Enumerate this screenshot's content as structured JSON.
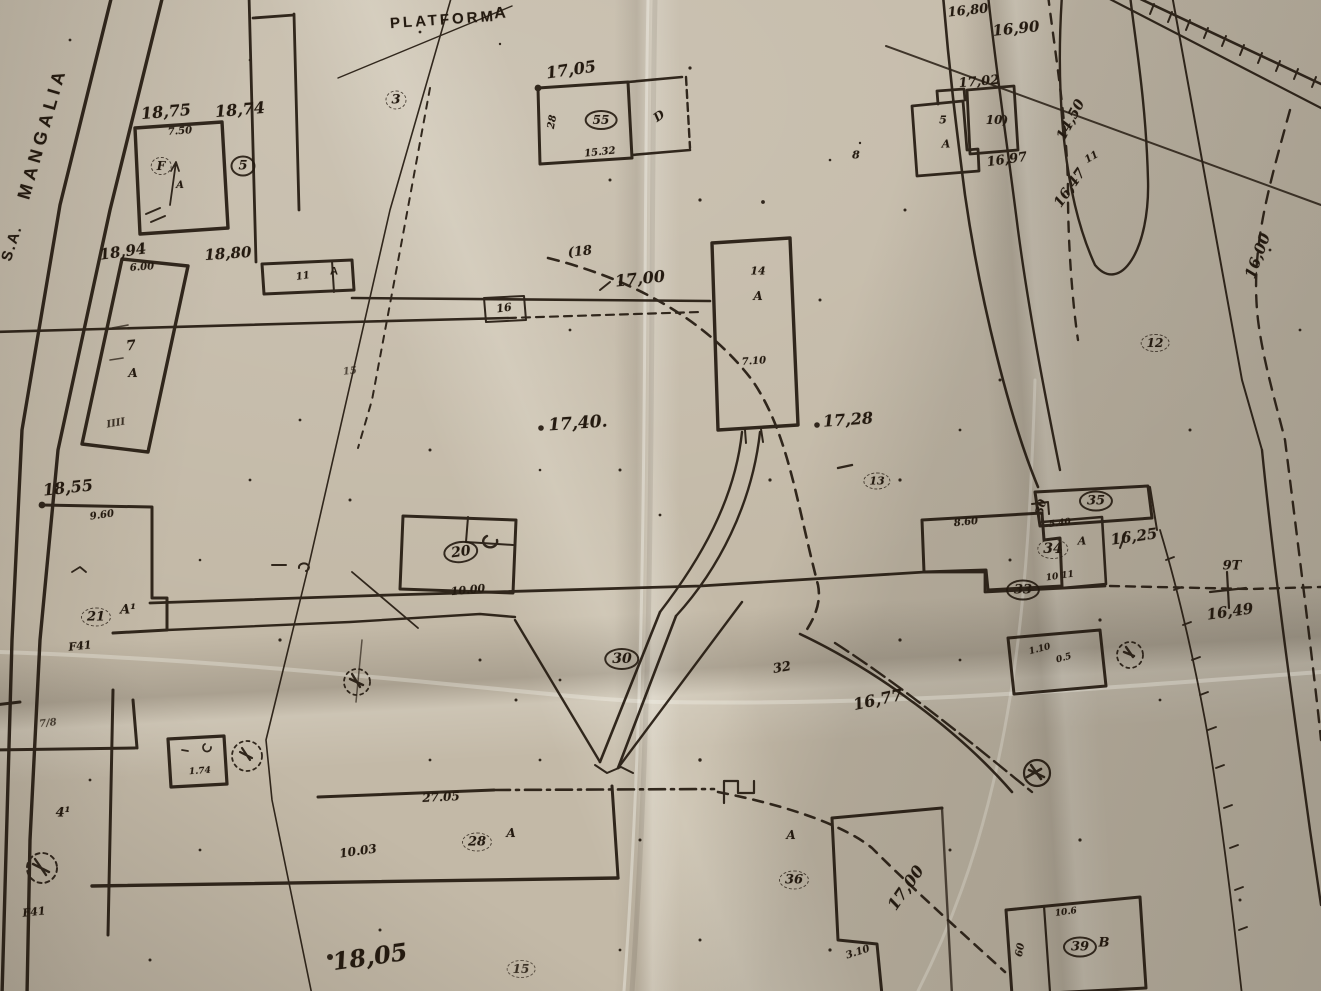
{
  "document": {
    "kind": "hand-drawn cadastral site plan on creased paper",
    "street_name": "MANGALIA",
    "street_prefix": "S.A.",
    "area_title": "PLATFORMA"
  },
  "colors": {
    "paper": "#c3b9a7",
    "paper_light": "#d6cdbc",
    "paper_shadow": "#968e80",
    "ink": "#241a10"
  },
  "labels": [
    {
      "id": "street-prefix",
      "t": "S.A.",
      "x": 12,
      "y": 243,
      "r": -72,
      "s": 15,
      "st": 1,
      "ls": 2
    },
    {
      "id": "street-mangalia",
      "t": "MANGALIA",
      "x": 42,
      "y": 133,
      "r": -74,
      "s": 18,
      "st": 1,
      "ls": 5
    },
    {
      "id": "platforma",
      "t": "PLATFORM",
      "x": 443,
      "y": 20,
      "r": -4,
      "s": 15,
      "st": 1,
      "ls": 3
    },
    {
      "id": "platforma-a",
      "t": "A",
      "x": 500,
      "y": 14,
      "r": -4,
      "s": 16,
      "st": 1
    },
    {
      "id": "pt-3",
      "t": "3",
      "x": 396,
      "y": 100,
      "r": 0,
      "s": 13,
      "c": "d"
    },
    {
      "id": "elev-1875",
      "t": "18,75",
      "x": 166,
      "y": 112,
      "r": -5,
      "s": 16
    },
    {
      "id": "dim-750",
      "t": "7.50",
      "x": 180,
      "y": 132,
      "r": -4,
      "s": 10
    },
    {
      "id": "bldg-F",
      "t": "F",
      "x": 161,
      "y": 166,
      "r": 0,
      "s": 12,
      "c": "d"
    },
    {
      "id": "bldg-F-a",
      "t": "A",
      "x": 180,
      "y": 186,
      "r": 0,
      "s": 10
    },
    {
      "id": "elev-1874",
      "t": "18,74",
      "x": 240,
      "y": 110,
      "r": -5,
      "s": 16
    },
    {
      "id": "pt-5",
      "t": "5",
      "x": 243,
      "y": 166,
      "r": 0,
      "s": 13,
      "c": "s"
    },
    {
      "id": "elev-1894",
      "t": "18,94",
      "x": 123,
      "y": 252,
      "r": -8,
      "s": 15
    },
    {
      "id": "elev-1880",
      "t": "18,80",
      "x": 228,
      "y": 254,
      "r": -4,
      "s": 15
    },
    {
      "id": "dim-600",
      "t": "6.00",
      "x": 142,
      "y": 268,
      "r": -4,
      "s": 10
    },
    {
      "id": "bldg-7",
      "t": "7",
      "x": 131,
      "y": 346,
      "r": -6,
      "s": 14
    },
    {
      "id": "bldg-7-a",
      "t": "A",
      "x": 133,
      "y": 373,
      "r": 0,
      "s": 12
    },
    {
      "id": "hatch-iiii",
      "t": "IIII",
      "x": 116,
      "y": 424,
      "r": -10,
      "s": 10,
      "o": 0.85
    },
    {
      "id": "box-11",
      "t": "11",
      "x": 303,
      "y": 277,
      "r": -8,
      "s": 10
    },
    {
      "id": "box-11-a",
      "t": "A",
      "x": 334,
      "y": 272,
      "r": 0,
      "s": 11,
      "st": 1
    },
    {
      "id": "road-16",
      "t": "16",
      "x": 504,
      "y": 308,
      "r": -8,
      "s": 11
    },
    {
      "id": "elev-1700",
      "t": "17,00",
      "x": 640,
      "y": 279,
      "r": -6,
      "s": 16
    },
    {
      "id": "ctr-18",
      "t": "(18",
      "x": 580,
      "y": 252,
      "r": -6,
      "s": 13
    },
    {
      "id": "pt-15a",
      "t": "15",
      "x": 350,
      "y": 372,
      "r": -6,
      "s": 10,
      "o": 0.7
    },
    {
      "id": "bldg-14",
      "t": "14",
      "x": 758,
      "y": 271,
      "r": 0,
      "s": 11
    },
    {
      "id": "bldg-14-a",
      "t": "A",
      "x": 758,
      "y": 296,
      "r": 0,
      "s": 12
    },
    {
      "id": "dim-710",
      "t": "7.10",
      "x": 754,
      "y": 362,
      "r": -4,
      "s": 10
    },
    {
      "id": "elev-1740",
      "t": "17,40.",
      "x": 578,
      "y": 424,
      "r": -4,
      "s": 17
    },
    {
      "id": "elev-1728",
      "t": "17,28",
      "x": 848,
      "y": 420,
      "r": -4,
      "s": 16
    },
    {
      "id": "ctr-13",
      "t": "13",
      "x": 877,
      "y": 481,
      "r": 0,
      "s": 11,
      "c": "d"
    },
    {
      "id": "pt-8",
      "t": "8",
      "x": 856,
      "y": 155,
      "r": 0,
      "s": 11
    },
    {
      "id": "elev-1680",
      "t": "16,80",
      "x": 968,
      "y": 11,
      "r": -6,
      "s": 13
    },
    {
      "id": "elev-1690",
      "t": "16,90",
      "x": 1016,
      "y": 29,
      "r": -6,
      "s": 15
    },
    {
      "id": "elev-1702",
      "t": "17,02",
      "x": 979,
      "y": 82,
      "r": -5,
      "s": 13
    },
    {
      "id": "bldg-5",
      "t": "5",
      "x": 943,
      "y": 120,
      "r": 0,
      "s": 11
    },
    {
      "id": "bldg-5-a",
      "t": "A",
      "x": 946,
      "y": 144,
      "r": 0,
      "s": 11
    },
    {
      "id": "bldg-10",
      "t": "10)",
      "x": 997,
      "y": 120,
      "r": 0,
      "s": 12
    },
    {
      "id": "elev-1697",
      "t": "16,97",
      "x": 1007,
      "y": 160,
      "r": -8,
      "s": 13
    },
    {
      "id": "elev-1450",
      "t": "14,50",
      "x": 1071,
      "y": 120,
      "r": -62,
      "s": 14
    },
    {
      "id": "elev-1647",
      "t": "16,47",
      "x": 1070,
      "y": 188,
      "r": -55,
      "s": 14
    },
    {
      "id": "marks-11",
      "t": "11",
      "x": 1092,
      "y": 158,
      "r": -30,
      "s": 10
    },
    {
      "id": "ctr-1600",
      "t": "16,00",
      "x": 1258,
      "y": 256,
      "r": -70,
      "s": 15
    },
    {
      "id": "pt-12",
      "t": "12",
      "x": 1155,
      "y": 343,
      "r": 0,
      "s": 12,
      "c": "d"
    },
    {
      "id": "elev-1855",
      "t": "18,55",
      "x": 68,
      "y": 488,
      "r": -6,
      "s": 16
    },
    {
      "id": "dim-960",
      "t": "9.60",
      "x": 102,
      "y": 516,
      "r": -8,
      "s": 10
    },
    {
      "id": "pt-21",
      "t": "21",
      "x": 96,
      "y": 617,
      "r": 0,
      "s": 13,
      "c": "d"
    },
    {
      "id": "pt-21-a1",
      "t": "A¹",
      "x": 128,
      "y": 610,
      "r": 0,
      "s": 13
    },
    {
      "id": "f41-a",
      "t": "F41",
      "x": 80,
      "y": 646,
      "r": -6,
      "s": 11
    },
    {
      "id": "pt-20",
      "t": "20",
      "x": 461,
      "y": 552,
      "r": -8,
      "s": 14,
      "c": "s"
    },
    {
      "id": "dim-1000",
      "t": "10.00",
      "x": 468,
      "y": 590,
      "r": -6,
      "s": 11
    },
    {
      "id": "pt-35",
      "t": "35",
      "x": 1096,
      "y": 501,
      "r": 0,
      "s": 13,
      "c": "s"
    },
    {
      "id": "dim-30",
      "t": "30",
      "x": 1041,
      "y": 507,
      "r": -75,
      "s": 11
    },
    {
      "id": "dim-860",
      "t": "8.60",
      "x": 966,
      "y": 523,
      "r": -6,
      "s": 10
    },
    {
      "id": "dim-540",
      "t": "5.40",
      "x": 1060,
      "y": 524,
      "r": -8,
      "s": 9
    },
    {
      "id": "pt-34",
      "t": "34",
      "x": 1053,
      "y": 549,
      "r": 0,
      "s": 14,
      "c": "d"
    },
    {
      "id": "pt-34-a",
      "t": "A",
      "x": 1082,
      "y": 541,
      "r": 0,
      "s": 11
    },
    {
      "id": "elev-1625",
      "t": "16,25",
      "x": 1134,
      "y": 537,
      "r": -8,
      "s": 15
    },
    {
      "id": "pt-33",
      "t": "33",
      "x": 1023,
      "y": 590,
      "r": 0,
      "s": 13,
      "c": "s"
    },
    {
      "id": "dim-1011",
      "t": "10 11",
      "x": 1060,
      "y": 577,
      "r": -8,
      "s": 9
    },
    {
      "id": "pt-9t",
      "t": "9T",
      "x": 1232,
      "y": 566,
      "r": 0,
      "s": 13
    },
    {
      "id": "elev-1649",
      "t": "16,49",
      "x": 1230,
      "y": 612,
      "r": -8,
      "s": 15
    },
    {
      "id": "pt-30",
      "t": "30",
      "x": 622,
      "y": 659,
      "r": 0,
      "s": 14,
      "c": "s"
    },
    {
      "id": "pt-32",
      "t": "32",
      "x": 782,
      "y": 668,
      "r": -10,
      "s": 13
    },
    {
      "id": "elev-1677",
      "t": "16,77",
      "x": 878,
      "y": 700,
      "r": -12,
      "s": 16
    },
    {
      "id": "dim-110",
      "t": "1.10",
      "x": 1040,
      "y": 650,
      "r": -15,
      "s": 9
    },
    {
      "id": "dim-05",
      "t": "0.5",
      "x": 1064,
      "y": 659,
      "r": -15,
      "s": 9
    },
    {
      "id": "dim-2705",
      "t": "27.05",
      "x": 441,
      "y": 797,
      "r": -3,
      "s": 12
    },
    {
      "id": "dim-1003",
      "t": "10.03",
      "x": 358,
      "y": 851,
      "r": -8,
      "s": 12
    },
    {
      "id": "pt-28",
      "t": "28",
      "x": 477,
      "y": 842,
      "r": 0,
      "s": 13,
      "c": "d"
    },
    {
      "id": "pt-28-a",
      "t": "A",
      "x": 511,
      "y": 833,
      "r": 0,
      "s": 12
    },
    {
      "id": "bldg-36-a",
      "t": "A",
      "x": 791,
      "y": 835,
      "r": 0,
      "s": 12
    },
    {
      "id": "pt-36",
      "t": "36",
      "x": 794,
      "y": 880,
      "r": 0,
      "s": 13,
      "c": "d"
    },
    {
      "id": "dim-310",
      "t": "3.10",
      "x": 858,
      "y": 953,
      "r": -18,
      "s": 10
    },
    {
      "id": "ctr-1700b",
      "t": "17,00",
      "x": 906,
      "y": 888,
      "r": -55,
      "s": 16
    },
    {
      "id": "dim-106",
      "t": "10.6",
      "x": 1066,
      "y": 913,
      "r": -8,
      "s": 9
    },
    {
      "id": "pt-39",
      "t": "39",
      "x": 1080,
      "y": 947,
      "r": 0,
      "s": 13,
      "c": "s"
    },
    {
      "id": "pt-39-b",
      "t": "B",
      "x": 1104,
      "y": 943,
      "r": 0,
      "s": 13
    },
    {
      "id": "dim-60",
      "t": "60",
      "x": 1021,
      "y": 950,
      "r": -80,
      "s": 10
    },
    {
      "id": "elev-1805",
      "t": "18,05",
      "x": 370,
      "y": 957,
      "r": -8,
      "s": 24
    },
    {
      "id": "pt-15b",
      "t": "15",
      "x": 521,
      "y": 969,
      "r": 0,
      "s": 12,
      "c": "d",
      "o": 0.85
    },
    {
      "id": "pt-41",
      "t": "4¹",
      "x": 63,
      "y": 813,
      "r": 0,
      "s": 13
    },
    {
      "id": "f41-b",
      "t": "F41",
      "x": 34,
      "y": 912,
      "r": -6,
      "s": 11
    },
    {
      "id": "dim-78",
      "t": "7/8",
      "x": 48,
      "y": 724,
      "r": -6,
      "s": 10,
      "o": 0.75
    },
    {
      "id": "dim-174",
      "t": "1.74",
      "x": 200,
      "y": 772,
      "r": -4,
      "s": 9
    },
    {
      "id": "pt-55",
      "t": "55",
      "x": 601,
      "y": 120,
      "r": 0,
      "s": 12,
      "c": "s"
    },
    {
      "id": "bldg-d",
      "t": "D",
      "x": 659,
      "y": 116,
      "r": -35,
      "s": 12
    },
    {
      "id": "dim-1532",
      "t": "15.32",
      "x": 600,
      "y": 153,
      "r": -6,
      "s": 10
    },
    {
      "id": "dim-28",
      "t": "28",
      "x": 553,
      "y": 122,
      "r": -80,
      "s": 10
    },
    {
      "id": "elev-1705",
      "t": "17,05",
      "x": 571,
      "y": 70,
      "r": -8,
      "s": 16
    }
  ]
}
